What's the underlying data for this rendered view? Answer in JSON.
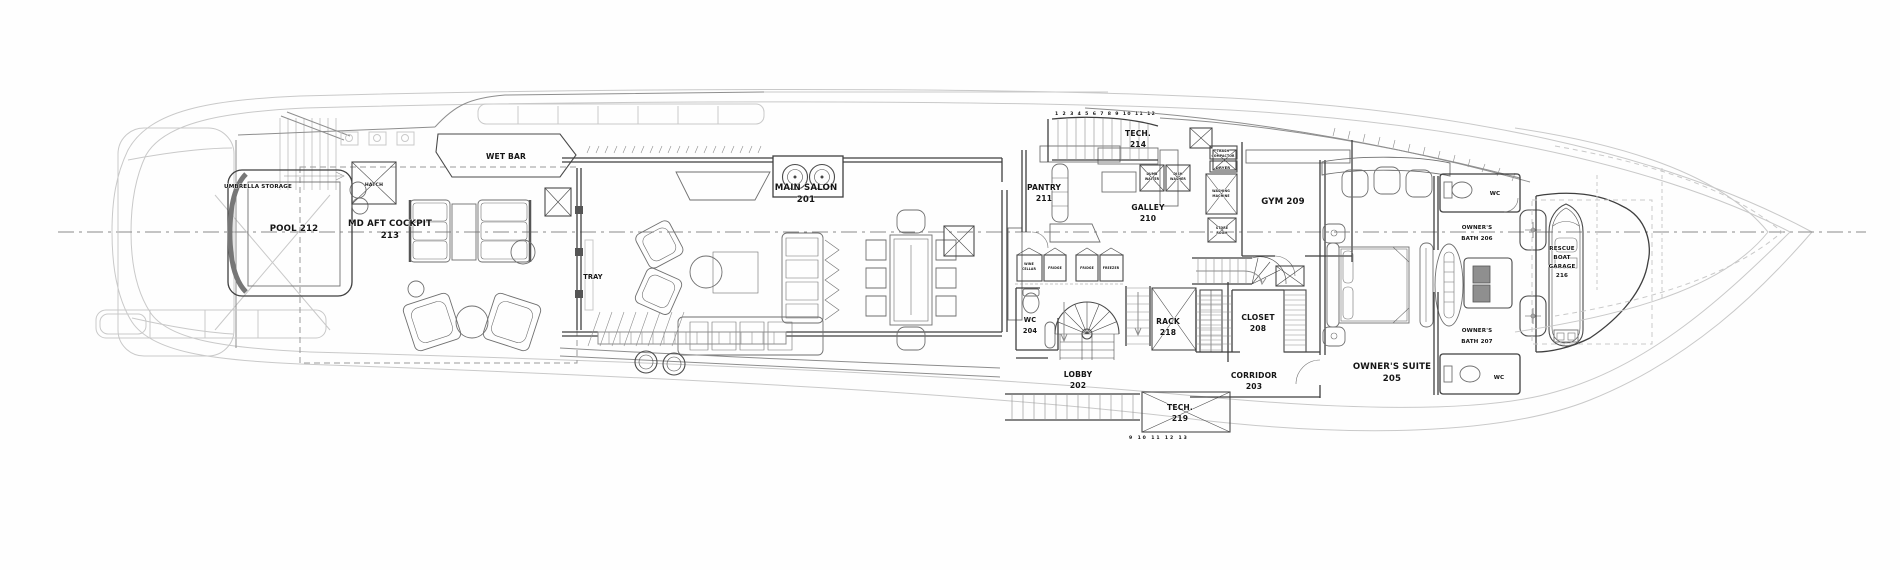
{
  "page": {
    "width": 1900,
    "height": 570,
    "background": "#fefefe"
  },
  "colors": {
    "line_dark": "#3f3f3f",
    "line_mid": "#8e8e8e",
    "line_faint": "#c9c9c9",
    "label": "#151515",
    "cabinet_fill": "#8f8f8f"
  },
  "plan": {
    "type": "yacht-main-deck-floor-plan",
    "rooms": [
      {
        "id": "main-salon",
        "l1": "MAIN SALON",
        "l2": "201"
      },
      {
        "id": "lobby",
        "l1": "LOBBY",
        "l2": "202"
      },
      {
        "id": "corridor",
        "l1": "CORRIDOR",
        "l2": "203"
      },
      {
        "id": "wc-mid",
        "l1": "WC",
        "l2": "204"
      },
      {
        "id": "owners-suite",
        "l1": "OWNER'S SUITE",
        "l2": "205"
      },
      {
        "id": "owners-bath-fwd",
        "l1": "OWNER'S",
        "l2": "BATH 206"
      },
      {
        "id": "owners-bath-aft",
        "l1": "OWNER'S",
        "l2": "BATH 207"
      },
      {
        "id": "closet",
        "l1": "CLOSET",
        "l2": "208"
      },
      {
        "id": "gym",
        "l1": "GYM 209"
      },
      {
        "id": "galley",
        "l1": "GALLEY",
        "l2": "210"
      },
      {
        "id": "pantry",
        "l1": "PANTRY",
        "l2": "211"
      },
      {
        "id": "pool",
        "l1": "POOL 212"
      },
      {
        "id": "md-aft-cockpit",
        "l1": "MD AFT COCKPIT",
        "l2": "213"
      },
      {
        "id": "tech-port",
        "l1": "TECH.",
        "l2": "214"
      },
      {
        "id": "rack",
        "l1": "RACK",
        "l2": "218"
      },
      {
        "id": "tech-stbd",
        "l1": "TECH.",
        "l2": "219"
      },
      {
        "id": "rescue-boat-garage",
        "l1": "RESCUE",
        "l2": "BOAT",
        "l3": "GARAGE",
        "l4": "216"
      }
    ],
    "annotations": {
      "wet_bar": "WET BAR",
      "tray": "TRAY",
      "hatch": "HATCH",
      "umbrella": "UMBRELLA STORAGE",
      "wc_fwd_top": "WC",
      "wc_fwd_bottom": "WC"
    },
    "appliances": {
      "wine_cellar_1": "WINE",
      "wine_cellar_2": "CELLAR",
      "fridge_1": "FRIDGE",
      "fridge_2": "FRIDGE",
      "freezer": "FREEZER",
      "dumb_waiter_1": "DUMB",
      "dumb_waiter_2": "WAITER",
      "dish_washer_1": "DISH",
      "dish_washer_2": "WASHER",
      "trash_compactor_1": "TRASH",
      "trash_compactor_2": "COMPACTOR",
      "dryer": "DRYER",
      "washing_machine_1": "WASHING",
      "washing_machine_2": "MACHINE",
      "store_room_1": "STORE",
      "store_room_2": "ROOM"
    },
    "stairs": {
      "tread_numbers_top": "1 2 3 4 5 6 7 8 9 10 11 12",
      "tread_numbers_bottom": "9 10 11 12 13"
    }
  }
}
